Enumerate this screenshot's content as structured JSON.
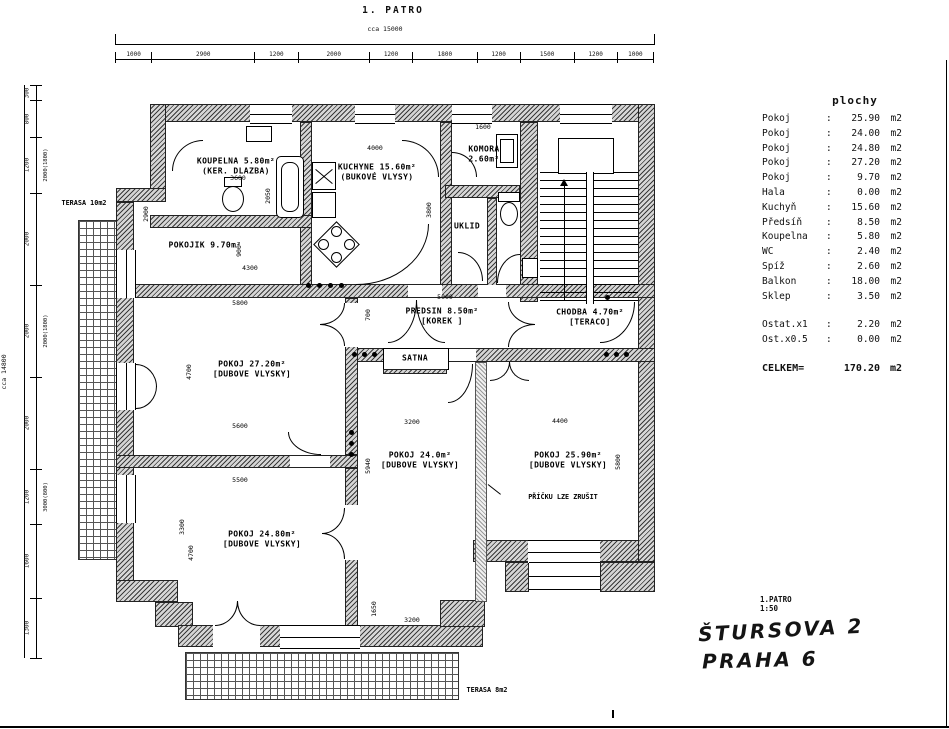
{
  "title": "1. PATRO",
  "plan": {
    "top_chain": {
      "overall": "cca 15000",
      "segments": [
        "1000",
        "2900",
        "1200",
        "2000",
        "1200",
        "1800",
        "1200",
        "1500",
        "1200",
        "1000"
      ]
    },
    "left_chain": {
      "overall": "cca 14800",
      "segments": [
        {
          "v": "300"
        },
        {
          "v": "800"
        },
        {
          "v": "1200",
          "alt": "2000(1800)"
        },
        {
          "v": "2000"
        },
        {
          "v": "2000",
          "alt": "2000(1800)"
        },
        {
          "v": "2000"
        },
        {
          "v": "1200",
          "alt": "3000(800)"
        },
        {
          "v": "1600"
        },
        {
          "v": "1300"
        }
      ]
    },
    "rooms": [
      {
        "lines": [
          "KOUPELNA 5.80m²",
          "(KER. DLAZBA)"
        ],
        "x": 236,
        "y": 166
      },
      {
        "lines": [
          "POKOJIK 9.70m²"
        ],
        "x": 205,
        "y": 245
      },
      {
        "lines": [
          "KUCHYNE 15.60m²",
          "(BUKOVÉ VLYSY)"
        ],
        "x": 377,
        "y": 172
      },
      {
        "lines": [
          "KOMORA",
          "2.60m²"
        ],
        "x": 484,
        "y": 154
      },
      {
        "lines": [
          "UKLID"
        ],
        "x": 467,
        "y": 226
      },
      {
        "lines": [
          "PREDSIN 8.50m²",
          "[KOREK ]"
        ],
        "x": 442,
        "y": 316
      },
      {
        "lines": [
          "SATNA"
        ],
        "x": 415,
        "y": 358
      },
      {
        "lines": [
          "CHODBA 4.70m²",
          "[TERACO]"
        ],
        "x": 590,
        "y": 317
      },
      {
        "lines": [
          "POKOJ 27.20m²",
          "[DUBOVE VLYSKY]"
        ],
        "x": 252,
        "y": 369
      },
      {
        "lines": [
          "POKOJ 24.80m²",
          "[DUBOVE VLYSKY]"
        ],
        "x": 262,
        "y": 539
      },
      {
        "lines": [
          "POKOJ 24.0m²",
          "[DUBOVE VLYSKY]"
        ],
        "x": 420,
        "y": 460
      },
      {
        "lines": [
          "POKOJ 25.90m²",
          "[DUBOVE VLYSKY]"
        ],
        "x": 568,
        "y": 460
      }
    ],
    "labels": [
      {
        "text": "TERASA 10m2",
        "x": 84,
        "y": 203
      },
      {
        "text": "TERASA 8m2",
        "x": 487,
        "y": 690
      },
      {
        "text": "PŘÍČKU LZE ZRUŠIT",
        "x": 563,
        "y": 497
      }
    ],
    "dims": [
      {
        "t": "3600",
        "x": 238,
        "y": 178
      },
      {
        "t": "2050",
        "x": 268,
        "y": 196,
        "v": true
      },
      {
        "t": "2900",
        "x": 146,
        "y": 214,
        "v": true
      },
      {
        "t": "4000",
        "x": 375,
        "y": 148
      },
      {
        "t": "1600",
        "x": 483,
        "y": 127
      },
      {
        "t": "3800",
        "x": 429,
        "y": 210,
        "v": true
      },
      {
        "t": "900",
        "x": 239,
        "y": 251,
        "v": true
      },
      {
        "t": "4300",
        "x": 250,
        "y": 268
      },
      {
        "t": "5800",
        "x": 240,
        "y": 303
      },
      {
        "t": "4700",
        "x": 189,
        "y": 372,
        "v": true
      },
      {
        "t": "5600",
        "x": 240,
        "y": 426
      },
      {
        "t": "5500",
        "x": 240,
        "y": 480
      },
      {
        "t": "3300",
        "x": 182,
        "y": 527,
        "v": true
      },
      {
        "t": "4700",
        "x": 191,
        "y": 553,
        "v": true
      },
      {
        "t": "5000",
        "x": 445,
        "y": 297
      },
      {
        "t": "700",
        "x": 368,
        "y": 315,
        "v": true
      },
      {
        "t": "3200",
        "x": 412,
        "y": 422
      },
      {
        "t": "5940",
        "x": 368,
        "y": 466,
        "v": true
      },
      {
        "t": "4400",
        "x": 560,
        "y": 421
      },
      {
        "t": "5800",
        "x": 618,
        "y": 462,
        "v": true
      },
      {
        "t": "3200",
        "x": 412,
        "y": 620
      },
      {
        "t": "1650",
        "x": 374,
        "y": 609,
        "v": true
      }
    ]
  },
  "areas_table": {
    "title": "plochy",
    "rows": [
      {
        "name": "Pokoj",
        "value": "25.90"
      },
      {
        "name": "Pokoj",
        "value": "24.00"
      },
      {
        "name": "Pokoj",
        "value": "24.80"
      },
      {
        "name": "Pokoj",
        "value": "27.20"
      },
      {
        "name": "Pokoj",
        "value": "9.70"
      },
      {
        "name": "Hala",
        "value": "0.00"
      },
      {
        "name": "Kuchyň",
        "value": "15.60"
      },
      {
        "name": "Předsíň",
        "value": "8.50"
      },
      {
        "name": "Koupelna",
        "value": "5.80"
      },
      {
        "name": "WC",
        "value": "2.40"
      },
      {
        "name": "Spíž",
        "value": "2.60"
      },
      {
        "name": "Balkon",
        "value": "18.00"
      },
      {
        "name": "Sklep",
        "value": "3.50"
      }
    ],
    "extra_rows": [
      {
        "name": "Ostat.x1",
        "value": "2.20"
      },
      {
        "name": "Ost.x0.5",
        "value": "0.00"
      }
    ],
    "unit": "m2",
    "total": {
      "name": "CELKEM=",
      "value": "170.20",
      "unit": "m2"
    }
  },
  "footer": {
    "floor": "1.PATRO",
    "scale": "1:50",
    "address_line1": "ŠTURSOVA 2",
    "address_line2": "PRAHA 6"
  }
}
